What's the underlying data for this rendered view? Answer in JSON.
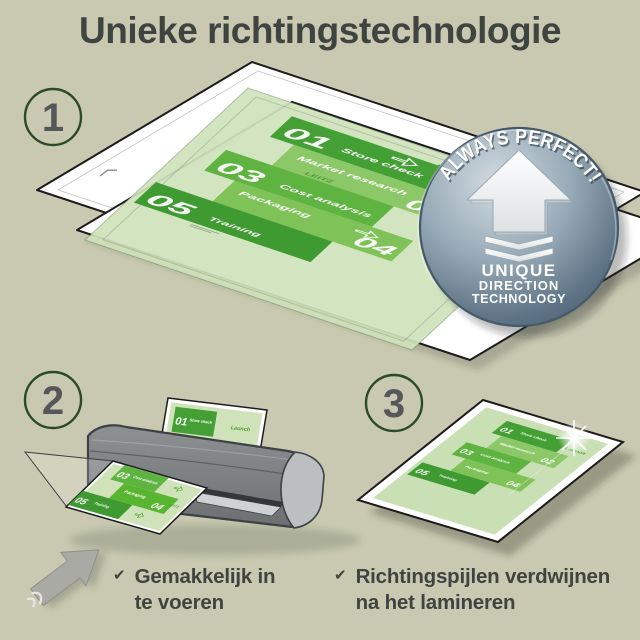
{
  "title": "Unieke richtingstechnologie",
  "steps": [
    {
      "number": "1"
    },
    {
      "number": "2"
    },
    {
      "number": "3"
    }
  ],
  "badge": {
    "arc_text": "ALWAYS PERFECT!",
    "line1": "UNIQUE",
    "line2": "DIRECTION",
    "line3": "TECHNOLOGY"
  },
  "doc": {
    "launch_label": "Launch",
    "watermark": "LEITZ",
    "items": [
      {
        "num": "01",
        "label": "Store check"
      },
      {
        "num": "02",
        "label": "Market research"
      },
      {
        "num": "03",
        "label": "Cost analysis"
      },
      {
        "num": "04",
        "label": "Packaging"
      },
      {
        "num": "05",
        "label": "Training"
      }
    ]
  },
  "captions": [
    {
      "check": "✔",
      "line1": "Gemakkelijk in",
      "line2": "te voeren"
    },
    {
      "check": "✔",
      "line1": "Richtingspijlen verdwijnen",
      "line2": "na het lamineren"
    }
  ],
  "colors": {
    "background": "#c8c9b0",
    "title_text": "#3f4441",
    "circle_ring_green": "#2b4a26",
    "block_green_dark": "#44a035",
    "block_green_medium": "#8cc868",
    "block_green": "#5fb341",
    "block_green_light": "#7fc257",
    "block_green_deep": "#3f9a31",
    "sheet_green": "#cfe2bc",
    "launch_green": "#4aa22c",
    "badge_blue": "#8ea3b1",
    "laminator_gray": "#84888b"
  }
}
